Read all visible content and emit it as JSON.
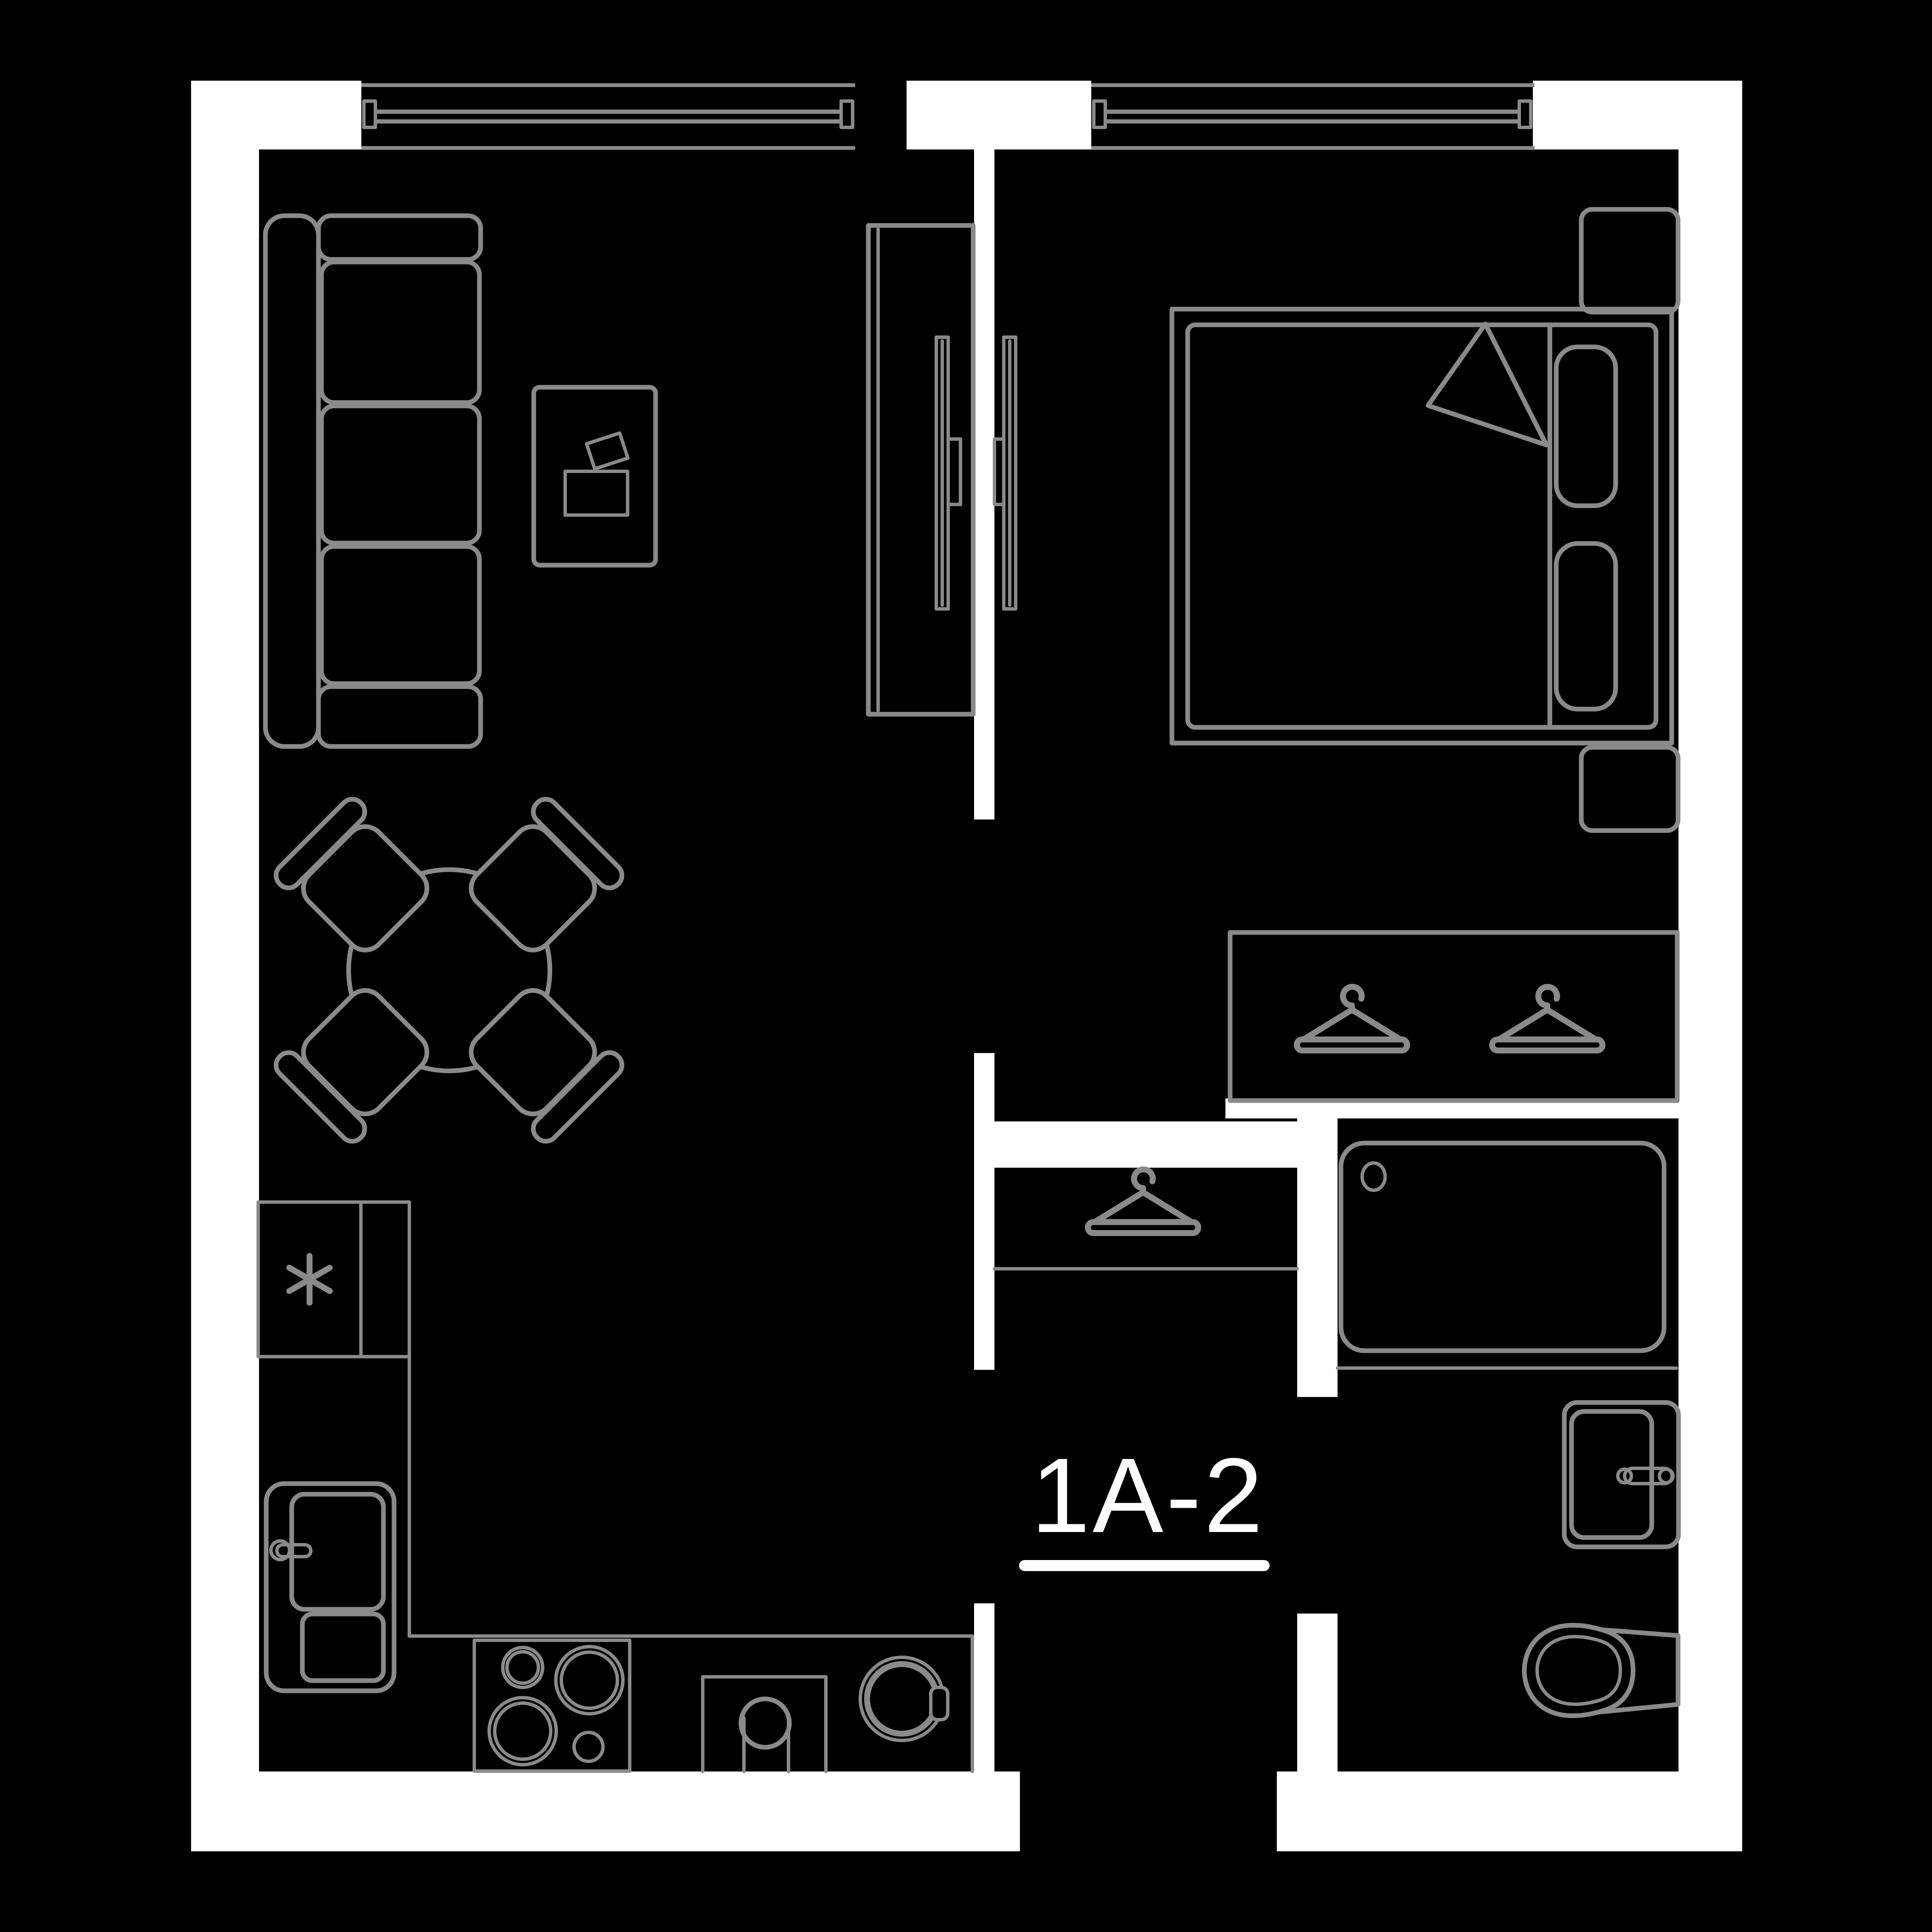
{
  "plan": {
    "unit_label": "1A-2",
    "colors": {
      "background": "#000000",
      "wall": "#ffffff",
      "furniture": "#8a8a8a",
      "label": "#ffffff"
    },
    "window_count": 2,
    "icons": [
      "window-icon",
      "sofa-icon",
      "coffee-table-icon",
      "tv-cabinet-icon",
      "tv-icon",
      "dining-table-icon",
      "dining-chair-icon",
      "bed-icon",
      "pillow-icon",
      "blanket-fold-icon",
      "nightstand-icon",
      "wardrobe-icon",
      "hanger-icon",
      "bathtub-icon",
      "washbasin-icon",
      "faucet-icon",
      "toilet-icon",
      "refrigerator-icon",
      "freezer-asterisk-icon",
      "kitchen-sink-icon",
      "hob-icon",
      "water-heater-icon",
      "washing-machine-icon"
    ]
  }
}
